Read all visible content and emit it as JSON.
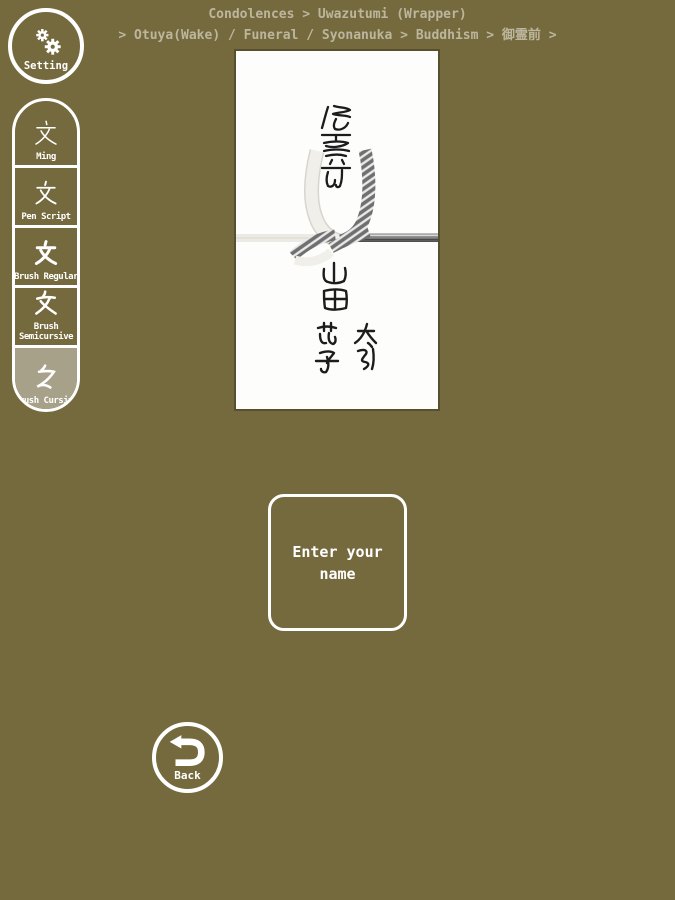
{
  "colors": {
    "background": "#756a3e",
    "selected_button_background": "#a8a189",
    "breadcrumb_text": "#bdb69e",
    "foreground": "#ffffff",
    "envelope_paper": "#fdfdfb",
    "mizuhiki_left_cord": "#efede8",
    "mizuhiki_right_cord": "#6b6b6b"
  },
  "breadcrumb": {
    "line1": "Condolences > Uwazutumi (Wrapper)",
    "line2": "> Otuya(Wake) / Funeral / Syonanuka > Buddhism > 御霊前 >"
  },
  "setting_button": {
    "label": "Setting"
  },
  "sidebar": {
    "items": [
      {
        "glyph": "文",
        "label": "Ming",
        "selected": false
      },
      {
        "glyph": "文",
        "label": "Pen Script",
        "selected": false
      },
      {
        "glyph": "文",
        "label": "Brush Regular",
        "selected": false
      },
      {
        "glyph": "文",
        "label": "Brush Semicursive",
        "selected": false
      },
      {
        "glyph": "文",
        "label": "Brush Cursive",
        "selected": true
      }
    ]
  },
  "envelope": {
    "title_text": "御霊前",
    "family_name": "山田",
    "given_names": [
      "太郎",
      "花子"
    ]
  },
  "enter_name_button": {
    "label": "Enter your\nname"
  },
  "back_button": {
    "label": "Back"
  }
}
